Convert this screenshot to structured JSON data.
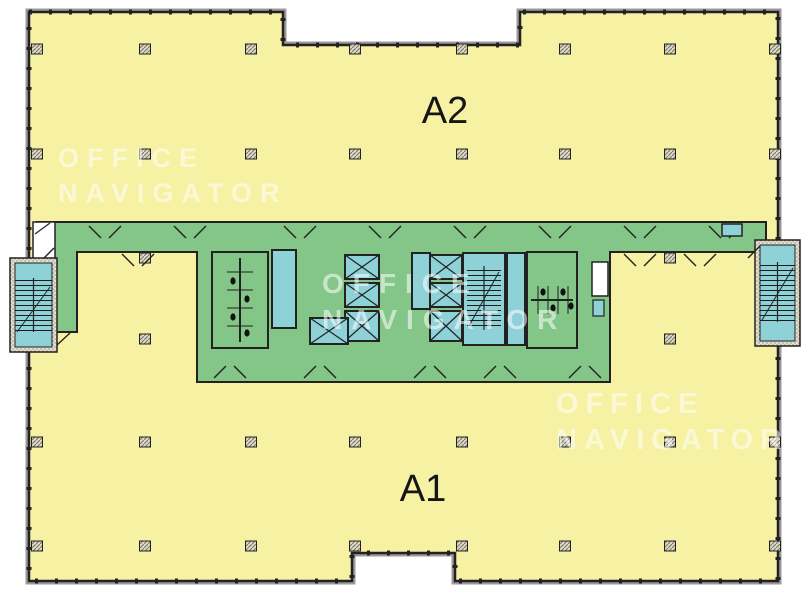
{
  "zones": {
    "a2": {
      "label": "A2"
    },
    "a1": {
      "label": "A1"
    }
  },
  "watermark": {
    "line1": "OFFICE",
    "line2": "NAVIGATOR"
  },
  "colors": {
    "floor_yellow": "#f6f1a3",
    "core_green": "#84c687",
    "shaft_teal": "#8ed2d8",
    "wall_black": "#222222",
    "outer_gray": "#9b9b9b",
    "hatch_tan": "#ddd8c2",
    "watermark_white": "#ffffff"
  }
}
